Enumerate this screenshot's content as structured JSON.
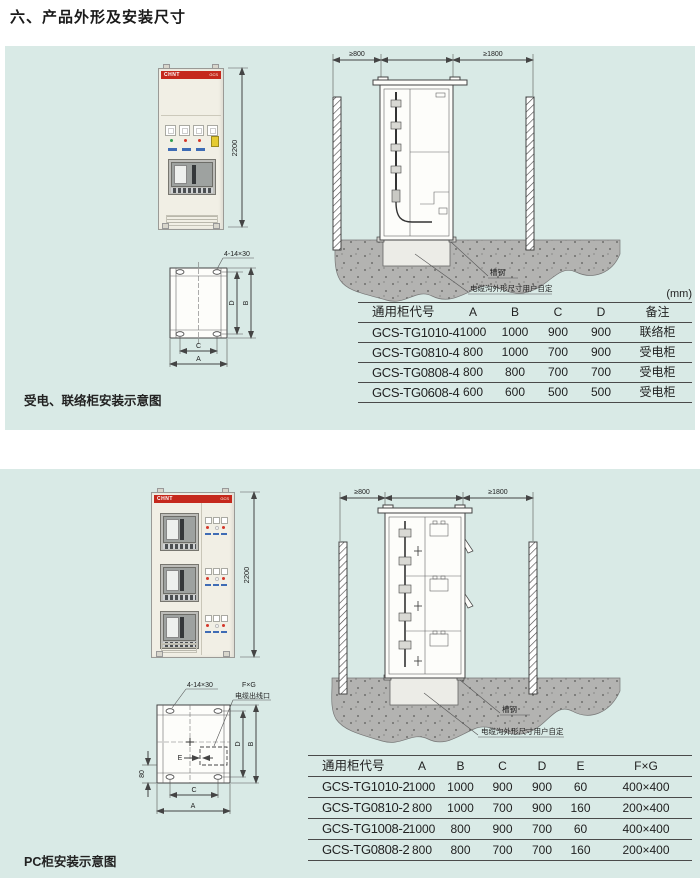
{
  "title": "六、产品外形及安装尺寸",
  "unit_label": "(mm)",
  "brand": {
    "logo": "CHNT",
    "series": "GCS"
  },
  "labels": {
    "hole": "4-14×30",
    "gap_left": "≥800",
    "gap_right": "≥1800",
    "height": "2200",
    "channel_steel": "槽钢",
    "trench_note": "电缆沟外形尺寸用户自定",
    "dim_a": "A",
    "dim_b": "B",
    "dim_c": "C",
    "dim_d": "D",
    "dim_e": "E",
    "dim_80": "80",
    "outlet_size": "F×G",
    "outlet_label": "电缆出线口"
  },
  "section1": {
    "caption": "受电、联络柜安装示意图",
    "table": {
      "headers": [
        "通用柜代号",
        "A",
        "B",
        "C",
        "D",
        "备注"
      ],
      "rows": [
        [
          "GCS-TG1010-4",
          "1000",
          "1000",
          "900",
          "900",
          "联络柜"
        ],
        [
          "GCS-TG0810-4",
          "800",
          "1000",
          "700",
          "900",
          "受电柜"
        ],
        [
          "GCS-TG0808-4",
          "800",
          "800",
          "700",
          "700",
          "受电柜"
        ],
        [
          "GCS-TG0608-4",
          "600",
          "600",
          "500",
          "500",
          "受电柜"
        ]
      ]
    }
  },
  "section2": {
    "caption": "PC柜安装示意图",
    "table": {
      "headers": [
        "通用柜代号",
        "A",
        "B",
        "C",
        "D",
        "E",
        "F×G"
      ],
      "rows": [
        [
          "GCS-TG1010-2",
          "1000",
          "1000",
          "900",
          "900",
          "60",
          "400×400"
        ],
        [
          "GCS-TG0810-2",
          "800",
          "1000",
          "700",
          "900",
          "160",
          "200×400"
        ],
        [
          "GCS-TG1008-2",
          "1000",
          "800",
          "900",
          "700",
          "60",
          "400×400"
        ],
        [
          "GCS-TG0808-2",
          "800",
          "800",
          "700",
          "700",
          "160",
          "200×400"
        ]
      ]
    }
  }
}
